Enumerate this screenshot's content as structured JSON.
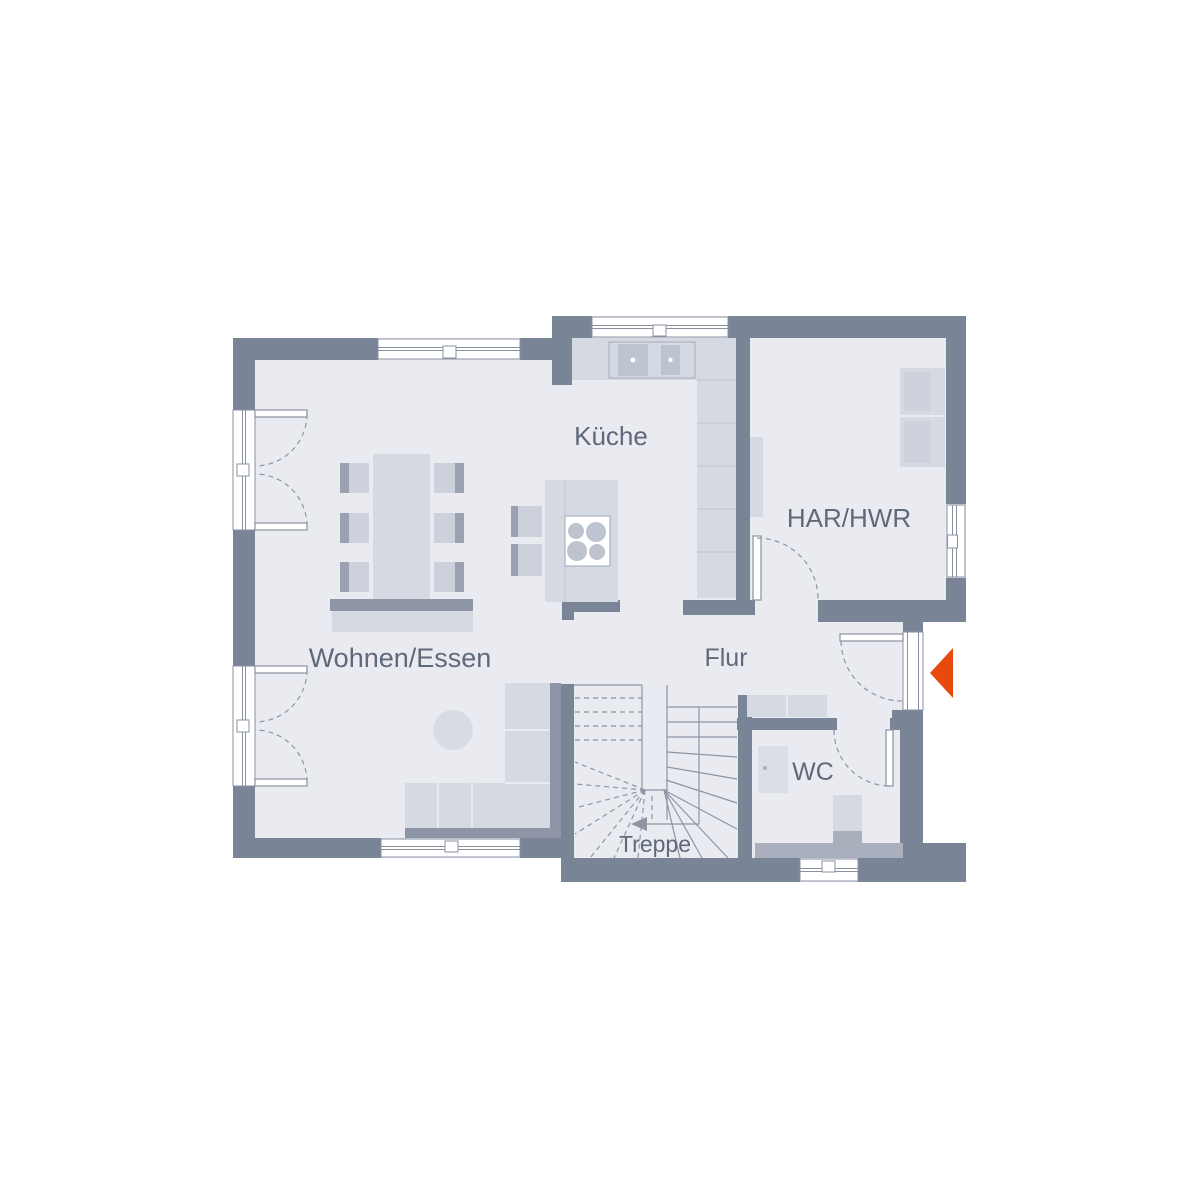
{
  "palette": {
    "background": "#FFFFFF",
    "wall": "#7A8497",
    "floor": "#E9EBF1",
    "furniture": "#D5D9E2",
    "furniture_soft": "#CCD1DC",
    "furniture_mid": "#A9AFBC",
    "furniture_shadow": "#8D95A6",
    "chair_back": "#9AA1B1",
    "detail": "#BDC3CF",
    "line": "#8A919F",
    "dash": "#8D95A3",
    "text": "#5F6979",
    "entry_accent": "#E8490D"
  },
  "rooms": [
    {
      "id": "kueche",
      "label": "Küche"
    },
    {
      "id": "har-hwr",
      "label": "HAR/HWR"
    },
    {
      "id": "wohnen-essen",
      "label": "Wohnen/Essen"
    },
    {
      "id": "flur",
      "label": "Flur"
    },
    {
      "id": "wc",
      "label": "WC"
    },
    {
      "id": "treppe",
      "label": "Treppe"
    }
  ],
  "entry_marker": {
    "shape": "triangle-pointing-left",
    "color": "#E8490D"
  }
}
